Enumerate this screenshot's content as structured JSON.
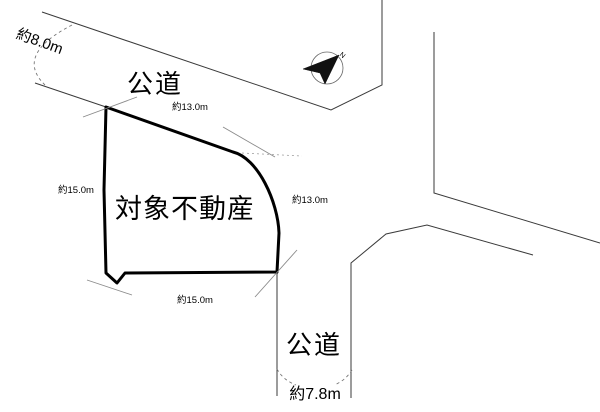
{
  "diagram": {
    "title": "site-plan",
    "property": {
      "label": "対象不動産"
    },
    "roads": [
      {
        "position": "top",
        "label": "公道",
        "width_label": "約8.0m"
      },
      {
        "position": "bottom",
        "label": "公道",
        "width_label": "約7.8m"
      }
    ],
    "boundary_dimensions": {
      "north_edge": "約13.0m",
      "east_edge": "約13.0m",
      "west_edge": "約15.0m",
      "south_edge": "約15.0m"
    },
    "north_marker": {
      "label": "N"
    },
    "colors": {
      "background": "#ffffff",
      "parcel_outline": "#000000",
      "road_line": "#3a3a3a",
      "construction_line": "#8a8a8a"
    }
  }
}
